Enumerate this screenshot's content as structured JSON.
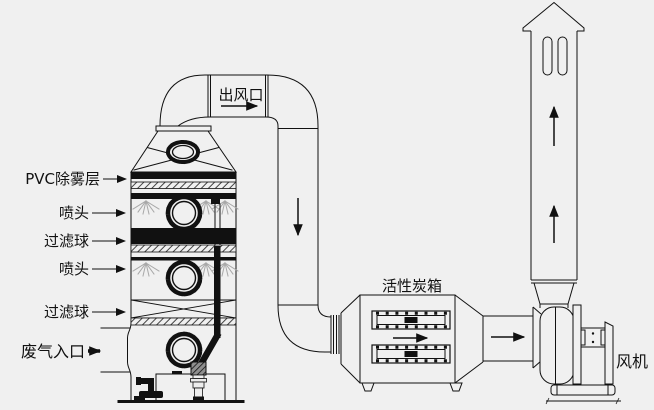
{
  "diagram": {
    "labels": {
      "pvc_demister": "PVC除雾层",
      "nozzle_top": "喷头",
      "filter_ball_top": "过滤球",
      "nozzle_bottom": "喷头",
      "filter_ball_bottom": "过滤球",
      "waste_gas_inlet": "废气入口",
      "air_outlet": "出风口",
      "activated_carbon_box": "活性炭箱",
      "fan": "风机"
    },
    "colors": {
      "background": "#f0f0f0",
      "line": "#111111",
      "spray": "#a8a8a8"
    }
  }
}
